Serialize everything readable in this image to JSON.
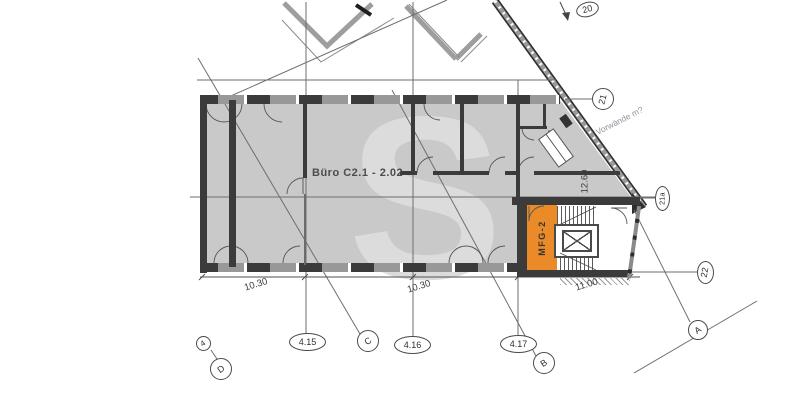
{
  "plan": {
    "office_room_label": "Büro C2.1 - 2.02",
    "stairwell_room_label": "MFG-2",
    "annotation_note": "Vorwände m?",
    "watermark_letter": "S"
  },
  "dimensions": {
    "bottom_left": "10.30",
    "bottom_mid": "10.30",
    "bottom_right": "11.00",
    "diagonal_depth": "12.60"
  },
  "axes": {
    "a20": "20",
    "a21": "21",
    "a21a": "21a",
    "a22": "22",
    "aA": "A",
    "aB": "B",
    "aC": "C",
    "aD": "D",
    "a4": "4",
    "a415": "4.15",
    "a416": "4.16",
    "a417": "4.17"
  },
  "colors": {
    "highlight_orange": "#EA8A28",
    "floor_gray": "#C9C9C9",
    "wall_dark": "#3B3B3B",
    "watermark_gray": "#DCDCDC"
  }
}
